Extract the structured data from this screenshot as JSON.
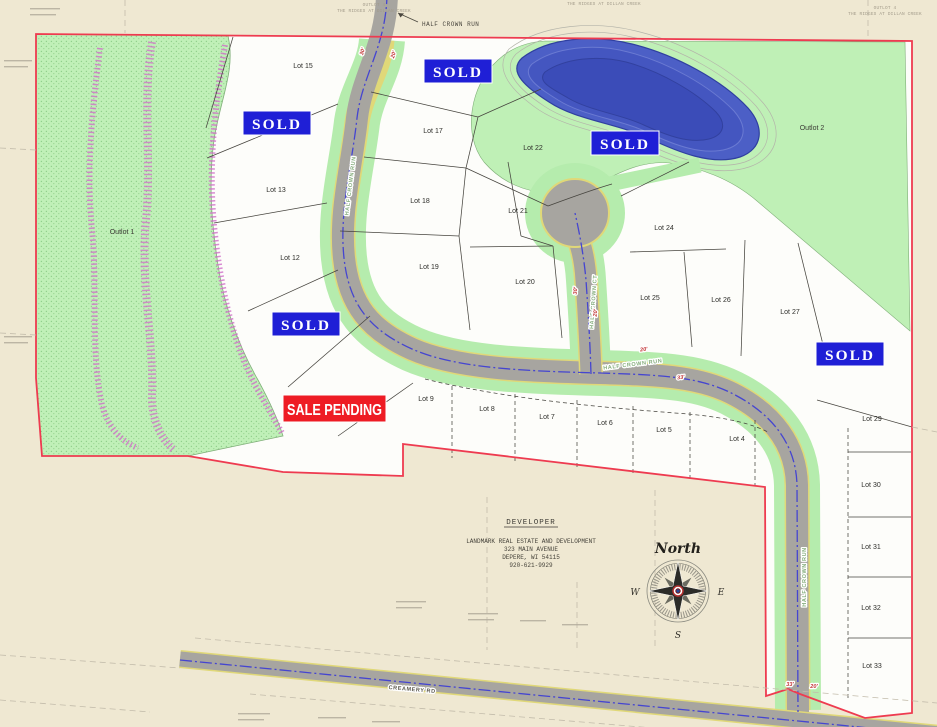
{
  "badges": {
    "sold_label": "SOLD",
    "sale_pending_label": "SALE PENDING"
  },
  "sold_positions": [
    {
      "x": 424,
      "y": 59
    },
    {
      "x": 243,
      "y": 111
    },
    {
      "x": 591,
      "y": 131
    },
    {
      "x": 272,
      "y": 312
    },
    {
      "x": 816,
      "y": 342
    }
  ],
  "sale_pending": {
    "x": 283,
    "y": 395,
    "w": 103,
    "h": 27
  },
  "outlots": [
    {
      "label": "Outlot 1",
      "x": 122,
      "y": 234
    },
    {
      "label": "Outlot 2",
      "x": 812,
      "y": 130
    }
  ],
  "lots": [
    {
      "label": "Lot 4",
      "x": 737,
      "y": 441
    },
    {
      "label": "Lot 5",
      "x": 664,
      "y": 432
    },
    {
      "label": "Lot 6",
      "x": 605,
      "y": 425
    },
    {
      "label": "Lot 7",
      "x": 547,
      "y": 419
    },
    {
      "label": "Lot 8",
      "x": 487,
      "y": 411
    },
    {
      "label": "Lot 9",
      "x": 426,
      "y": 401
    },
    {
      "label": "Lot 12",
      "x": 290,
      "y": 260
    },
    {
      "label": "Lot 13",
      "x": 276,
      "y": 192
    },
    {
      "label": "Lot 15",
      "x": 303,
      "y": 68
    },
    {
      "label": "Lot 17",
      "x": 433,
      "y": 133
    },
    {
      "label": "Lot 18",
      "x": 420,
      "y": 203
    },
    {
      "label": "Lot 19",
      "x": 429,
      "y": 269
    },
    {
      "label": "Lot 20",
      "x": 525,
      "y": 284
    },
    {
      "label": "Lot 21",
      "x": 518,
      "y": 213
    },
    {
      "label": "Lot 22",
      "x": 533,
      "y": 150
    },
    {
      "label": "Lot 24",
      "x": 664,
      "y": 230
    },
    {
      "label": "Lot 25",
      "x": 650,
      "y": 300
    },
    {
      "label": "Lot 26",
      "x": 721,
      "y": 302
    },
    {
      "label": "Lot 27",
      "x": 790,
      "y": 314
    },
    {
      "label": "Lot 29",
      "x": 872,
      "y": 421
    },
    {
      "label": "Lot 30",
      "x": 871,
      "y": 487
    },
    {
      "label": "Lot 31",
      "x": 871,
      "y": 549
    },
    {
      "label": "Lot 32",
      "x": 871,
      "y": 610
    },
    {
      "label": "Lot 33",
      "x": 872,
      "y": 668
    }
  ],
  "streets": [
    {
      "name": "HALF CROWN RUN",
      "x": 352,
      "y": 186,
      "rotate": -83
    },
    {
      "name": "HALF CROWN RUN",
      "x": 633,
      "y": 366,
      "rotate": -7
    },
    {
      "name": "HALF CROWN CT",
      "x": 595,
      "y": 302,
      "rotate": -86
    },
    {
      "name": "HALF CROWN RUN",
      "x": 806,
      "y": 577,
      "rotate": -90
    },
    {
      "name": "CREAMERY RD",
      "x": 412,
      "y": 691,
      "rotate": 5,
      "dark": true
    }
  ],
  "top_road_callout": {
    "label": "HALF CROWN RUN"
  },
  "dimensions": [
    {
      "value": "30'",
      "x": 364,
      "y": 52,
      "rotate": -72
    },
    {
      "value": "20'",
      "x": 395,
      "y": 55,
      "rotate": -72
    },
    {
      "value": "30'",
      "x": 577,
      "y": 291,
      "rotate": -84
    },
    {
      "value": "20'",
      "x": 597,
      "y": 313,
      "rotate": -84
    },
    {
      "value": "20'",
      "x": 644,
      "y": 351,
      "rotate": -7
    },
    {
      "value": "33'",
      "x": 681,
      "y": 379,
      "rotate": -7
    },
    {
      "value": "33'",
      "x": 790,
      "y": 686,
      "rotate": 0
    },
    {
      "value": "20'",
      "x": 814,
      "y": 688,
      "rotate": 0
    }
  ],
  "plat_notes": [
    {
      "text": "OUTLOT 4",
      "x": 374,
      "y": 6
    },
    {
      "text": "THE RIDGES AT DILLAN CREEK",
      "x": 374,
      "y": 12
    },
    {
      "text": "THE RIDGES AT DILLAN CREEK",
      "x": 604,
      "y": 5
    },
    {
      "text": "OUTLOT 4",
      "x": 885,
      "y": 9
    },
    {
      "text": "THE RIDGES AT DILLAN CREEK",
      "x": 885,
      "y": 15
    }
  ],
  "developer": {
    "heading": "DEVELOPER",
    "lines": [
      "LANDMARK REAL ESTATE AND DEVELOPMENT",
      "323 MAIN AVENUE",
      "DEPERE, WI 54115",
      "920-621-9929"
    ]
  },
  "compass": {
    "north": "North",
    "west": "W",
    "east": "E",
    "south": "S"
  },
  "colors": {
    "boundary_red": "#ee3b50",
    "sold_blue": "#1f1fd6",
    "pending_red": "#ee1c24",
    "outlot_green": "#bff0b6",
    "pond_blue": "#4c5fc6",
    "road_gray": "#a7a5a0"
  }
}
